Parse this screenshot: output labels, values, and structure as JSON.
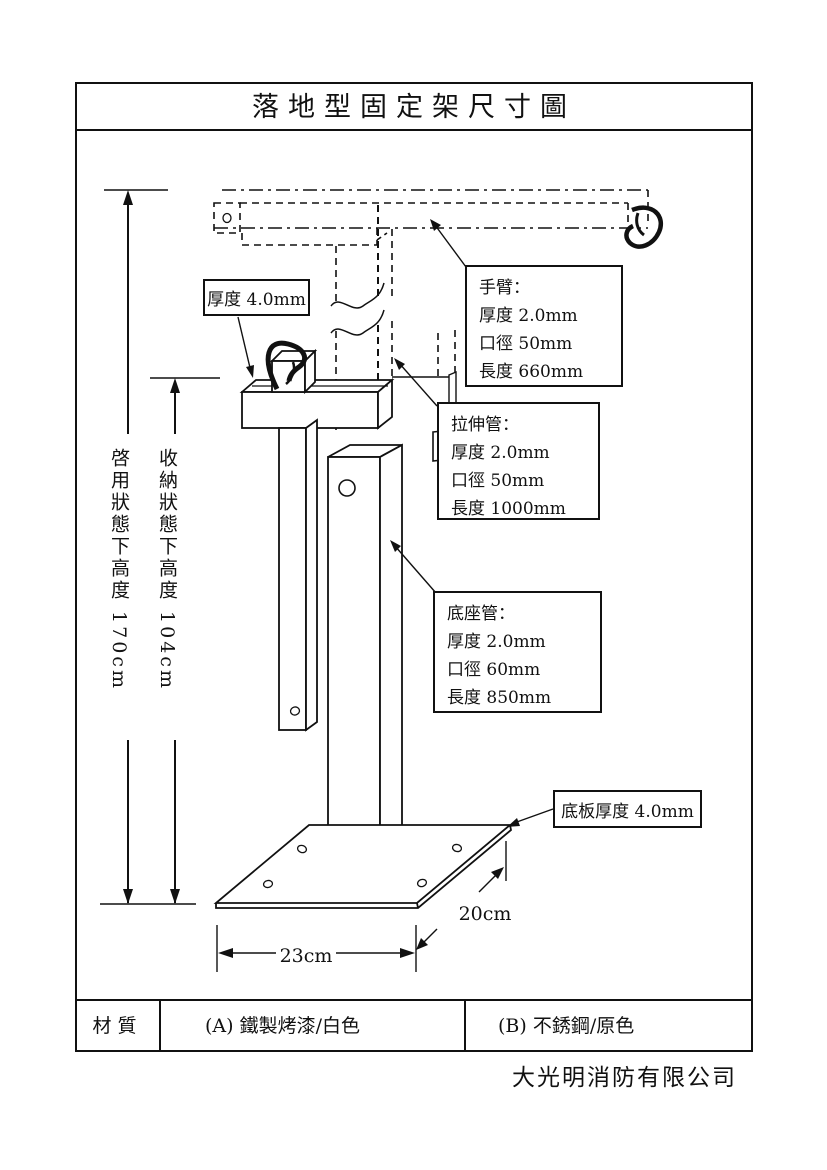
{
  "title": "落地型固定架尺寸圖",
  "labels": {
    "thickness_top": "厚度 4.0mm",
    "arm": {
      "title": "手臂：",
      "lines": [
        "厚度 2.0mm",
        "口徑 50mm",
        "長度 660mm"
      ]
    },
    "extension": {
      "title": "拉伸管：",
      "lines": [
        "厚度 2.0mm",
        "口徑 50mm",
        "長度 1000mm"
      ]
    },
    "base_tube": {
      "title": "底座管：",
      "lines": [
        "厚度 2.0mm",
        "口徑 60mm",
        "長度 850mm"
      ]
    },
    "base_plate": "底板厚度 4.0mm"
  },
  "dimensions": {
    "deployed_height": "啓用狀態下高度 170cm",
    "stored_height": "收納狀態下高度 104cm",
    "plate_width": "23cm",
    "plate_depth": "20cm"
  },
  "material_row": {
    "header": "材質",
    "option_a": "(A) 鐵製烤漆/白色",
    "option_b": "(B) 不銹鋼/原色"
  },
  "company": "大光明消防有限公司"
}
